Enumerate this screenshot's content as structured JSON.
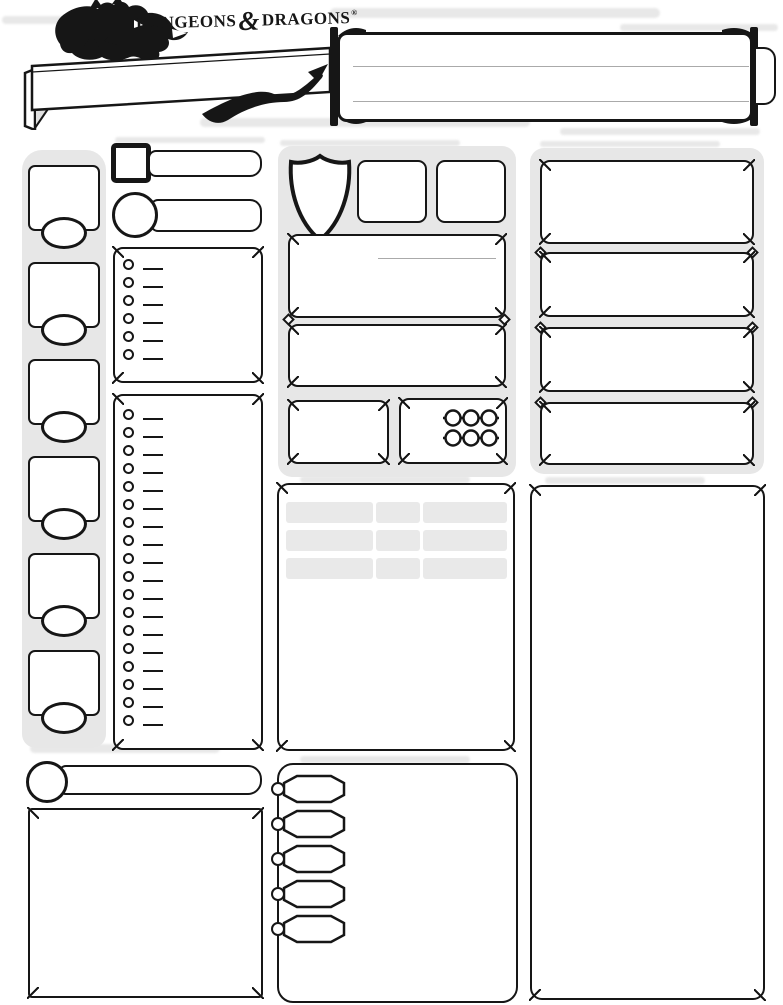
{
  "header": {
    "logo": {
      "word1": "DUNGEONS",
      "ampersand": "&",
      "word2": "DRAGONS",
      "registered": "®"
    },
    "character_name_banner": {
      "value": ""
    },
    "info_box": {
      "ruled_lines": 2,
      "row_values": [
        "",
        "",
        ""
      ]
    }
  },
  "abilities": {
    "count": 6,
    "boxes": [
      {
        "score": "",
        "modifier": ""
      },
      {
        "score": "",
        "modifier": ""
      },
      {
        "score": "",
        "modifier": ""
      },
      {
        "score": "",
        "modifier": ""
      },
      {
        "score": "",
        "modifier": ""
      },
      {
        "score": "",
        "modifier": ""
      }
    ]
  },
  "proficiency": {
    "inspiration_value": "",
    "proficiency_bonus_value": ""
  },
  "saving_throws": {
    "rows": 6,
    "values": [
      "",
      "",
      "",
      "",
      "",
      ""
    ]
  },
  "skills": {
    "rows": 18,
    "values": [
      "",
      "",
      "",
      "",
      "",
      "",
      "",
      "",
      "",
      "",
      "",
      "",
      "",
      "",
      "",
      "",
      "",
      ""
    ]
  },
  "combat": {
    "armor_class": "",
    "initiative": "",
    "speed": "",
    "hit_point_maximum": "",
    "current_hit_points": "",
    "temporary_hit_points": "",
    "hit_dice": "",
    "death_saves": {
      "rows": 2,
      "circles_per_row": 3,
      "marked": 0
    }
  },
  "attacks": {
    "rows": 3,
    "columns": 3,
    "cells": [
      [
        "",
        "",
        ""
      ],
      [
        "",
        "",
        ""
      ],
      [
        "",
        "",
        ""
      ]
    ]
  },
  "passive_perception": {
    "value": ""
  },
  "other_proficiencies_languages": {
    "text": ""
  },
  "equipment": {
    "coin_pouches": 5,
    "coin_values": [
      "",
      "",
      "",
      "",
      ""
    ],
    "text": ""
  },
  "character_traits": {
    "boxes": 4,
    "values": [
      "",
      "",
      "",
      ""
    ]
  },
  "features_and_traits": {
    "text": ""
  },
  "colors": {
    "ink": "#161616",
    "panel_gray": "#e7e7e7",
    "attack_cell_gray": "#e9e9e9",
    "ruled_line_gray": "#aaaaaa",
    "smudge_gray": "#dcdcdc"
  }
}
